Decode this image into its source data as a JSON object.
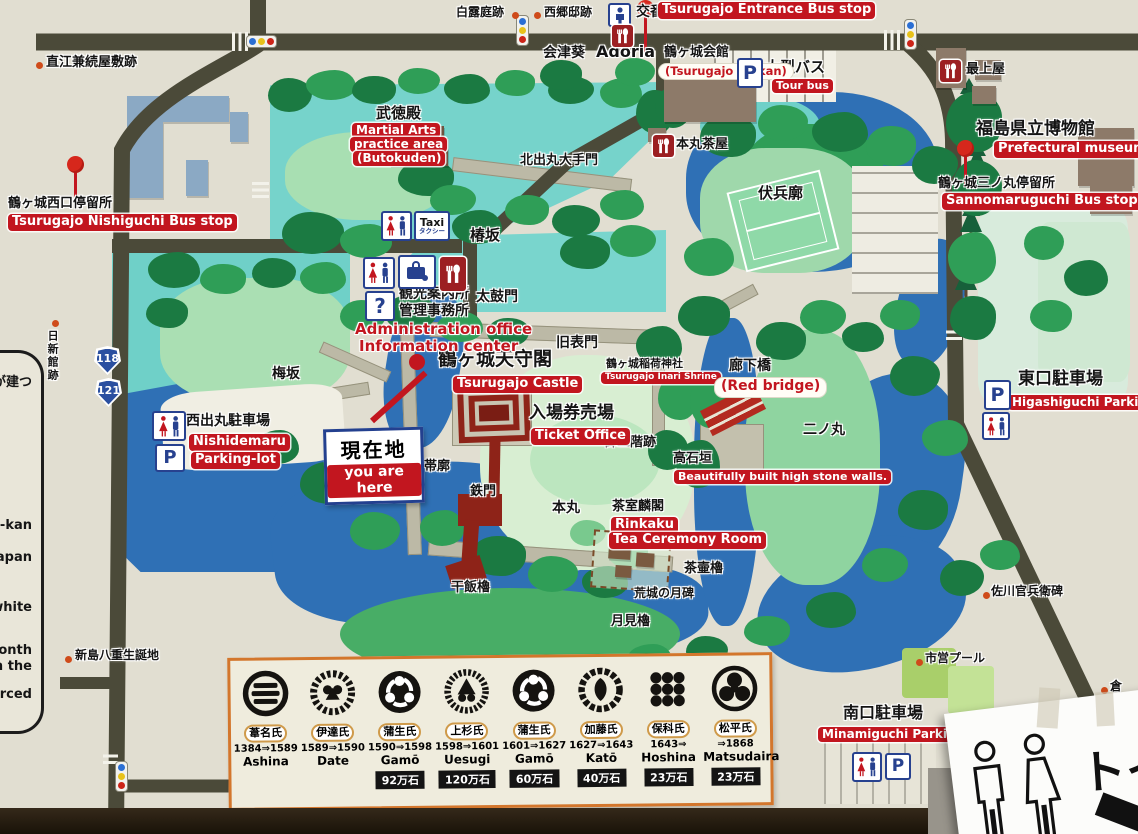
{
  "labels": {
    "naoe": "直江兼続屋敷跡",
    "hakuro": "白露庭跡",
    "saigo": "西郷邸跡",
    "koban": "交番",
    "entrance_bus": "Tsurugajo Entrance Bus stop",
    "aizu_aoi": "会津葵",
    "adoria": "Adoria",
    "kaikan_jp": "鶴ヶ城会館",
    "kaikan_en": "(Tsurugajo Kaikan)",
    "tourbus_jp": "大型バス",
    "tourbus_en": "Tour bus",
    "mogamiya": "最上屋",
    "museum_jp": "福島県立博物館",
    "museum_en": "Prefectural museum",
    "sannomaru_bus_jp": "鶴ヶ城三ノ丸停留所",
    "sannomaru_bus_en": "Sannomaruguchi Bus stop",
    "butokuden_jp": "武徳殿",
    "butokuden_en1": "Martial Arts",
    "butokuden_en2": "practice area",
    "butokuden_en3": "(Butokuden)",
    "kitademaru_gate": "北出丸大手門",
    "honmaru_chaya": "本丸茶屋",
    "fukubei": "伏兵廓",
    "tsubaki": "椿坂",
    "office_l1": "観光案内所",
    "office_l2": "管理事務所",
    "admin_en1": "Administration office",
    "admin_en2": "Information center",
    "taiko": "太鼓門",
    "kyuomote": "旧表門",
    "castle_jp": "鶴ヶ城天守閣",
    "castle_en": "Tsurugajo Castle",
    "inari_jp": "鶴ヶ城稲荷神社",
    "inari_en": "Tsurugajo Inari Shrine",
    "rokabashi_jp": "廊下橋",
    "rokabashi_en": "(Red bridge)",
    "ticket_jp": "入場券売場",
    "ticket_en": "Ticket Office",
    "gosankai": "御三階跡",
    "takaishigaki_jp": "高石垣",
    "takaishigaki_en": "Beautifully built high stone walls.",
    "ninomaru": "二ノ丸",
    "higashi_jp": "東口駐車場",
    "higashi_en": "Higashiguchi Parking-lot",
    "nishidemaru_jp": "西出丸駐車場",
    "nishidemaru_en1": "Nishidemaru",
    "nishidemaru_en2": "Parking-lot",
    "genzaichi_jp": "現在地",
    "genzaichi_en": "you are here",
    "umesaka": "梅坂",
    "obikuruwa": "帯廓",
    "tetsumon": "鉄門",
    "honmaru": "本丸",
    "rinkaku_jp": "茶室麟閣",
    "rinkaku_en1": "Rinkaku",
    "rinkaku_en2": "Tea Ceremony Room",
    "hoshii": "干飯櫓",
    "kojo": "荒城の月碑",
    "tsukimi": "月見櫓",
    "chatsubo": "茶壷櫓",
    "sagawa": "佐川官兵衛碑",
    "pool": "市営プール",
    "bunka": "会津若松市文化セ",
    "nogaku": "能楽堂",
    "minamiguchi_jp": "南口駐車場",
    "minamiguchi_en": "Minamiguchi Parking-lot",
    "niijima": "新島八重生誕地",
    "nisshinkan": "日新館跡",
    "nishiguchi_bus_jp": "鶴ヶ城西口停留所",
    "nishiguchi_bus_en": "Tsurugajo Nishiguchi Bus stop",
    "kura": "倉"
  },
  "icons": {
    "taxi": "Taxi",
    "taxi_kana": "タクシー",
    "question": "?",
    "parking": "P"
  },
  "routes": {
    "r118": "118",
    "r121": "121"
  },
  "legend": {
    "clans": [
      {
        "name": "葦名氏",
        "years": "1384⇒1589",
        "romaji": "Ashina",
        "koku": ""
      },
      {
        "name": "伊達氏",
        "years": "1589⇒1590",
        "romaji": "Date",
        "koku": ""
      },
      {
        "name": "蒲生氏",
        "years": "1590⇒1598",
        "romaji": "Gamō",
        "koku": "92万石"
      },
      {
        "name": "上杉氏",
        "years": "1598⇒1601",
        "romaji": "Uesugi",
        "koku": "120万石"
      },
      {
        "name": "蒲生氏",
        "years": "1601⇒1627",
        "romaji": "Gamō",
        "koku": "60万石"
      },
      {
        "name": "加藤氏",
        "years": "1627⇒1643",
        "romaji": "Katō",
        "koku": "40万石"
      },
      {
        "name": "保科氏",
        "years": "1643⇒",
        "romaji": "Hoshina",
        "koku": "23万石"
      },
      {
        "name": "松平氏",
        "years": "⇒1868",
        "romaji": "Matsudaira",
        "koku": "23万石"
      }
    ]
  },
  "left_panel": {
    "fragments": [
      "が建つ",
      "-kan",
      "n Japan",
      "y white",
      "a month",
      "n the",
      "rced"
    ]
  },
  "paper_sign": {
    "text": "トイ"
  },
  "colors": {
    "label_red": "#c2161f",
    "road": "#4b4a39",
    "water_blue": "#2f70b5",
    "water_cyan": "#74d2ca",
    "green_dark": "#1b7a42",
    "bg": "#e1ded1"
  }
}
